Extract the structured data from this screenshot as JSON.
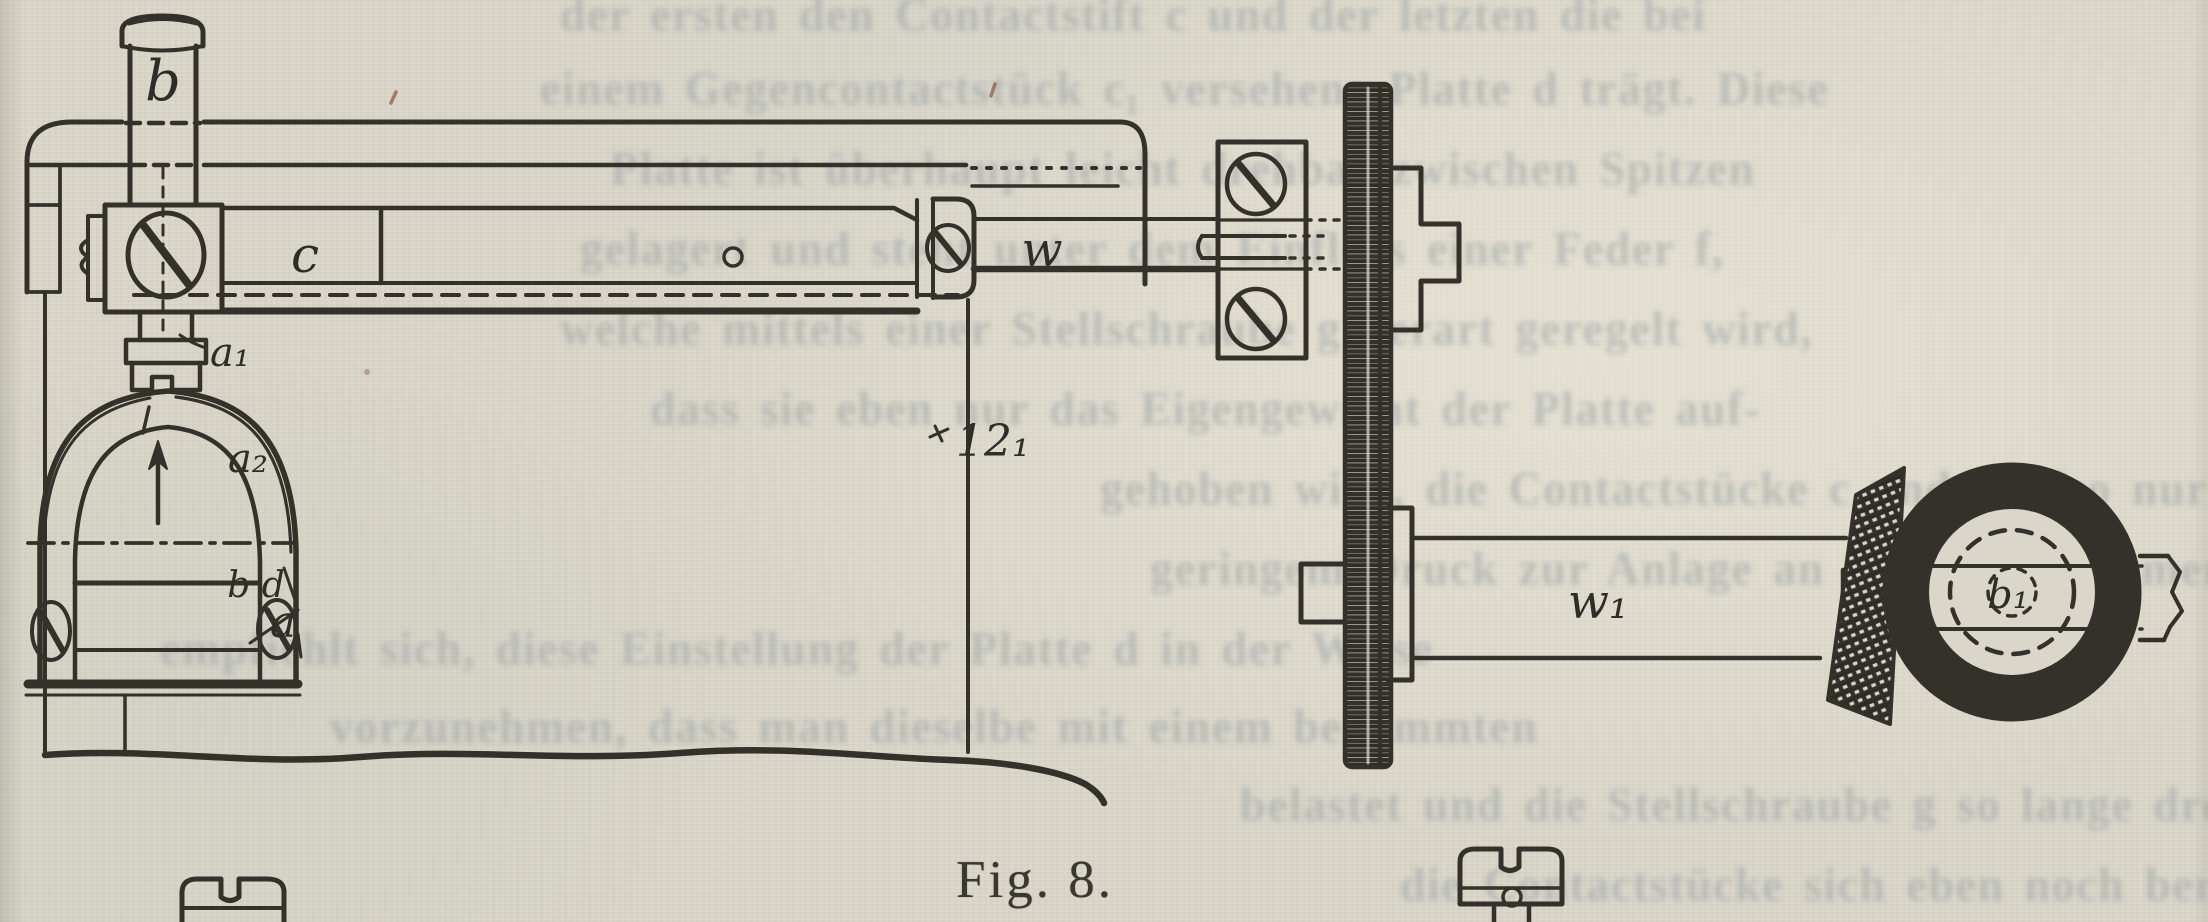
{
  "figure": {
    "caption": "Fig. 8.",
    "labels": {
      "cylinder": "b",
      "slide_bar": "c",
      "clamp_foot": "a₁",
      "arch_outer": "a₂",
      "arch_contacts": "b d",
      "arch_base": "a",
      "frame_edge": "12₁",
      "worm_shaft": "w",
      "gear_shaft": "w₁",
      "knurled_knob": "b₁"
    }
  },
  "ghost_text": {
    "lines": [
      "der ersten den Contactstift c und der letzten die bei",
      "einem Gegencontactstück c₁ versehene Platte d trägt. Diese",
      "Platte ist überhaupt leicht drehbar zwischen Spitzen",
      "gelagert und steht unter dem Einfluss einer Feder f,",
      "welche mittels einer Stellschraube g derart geregelt wird,",
      "dass sie eben nur das Eigengewicht der Platte auf-",
      "gehoben wird, die Contactstücke c und c₁ also nur unter",
      "geringem Druck zur Anlage an einander kommen. Es",
      "empfiehlt sich, diese Einstellung der Platte d in der Weise",
      "vorzunehmen, dass man dieselbe mit einem bestimmten",
      "belastet und die Stellschraube g so lange dreht, bis",
      "die Contactstücke sich eben noch berühren. Der"
    ]
  }
}
